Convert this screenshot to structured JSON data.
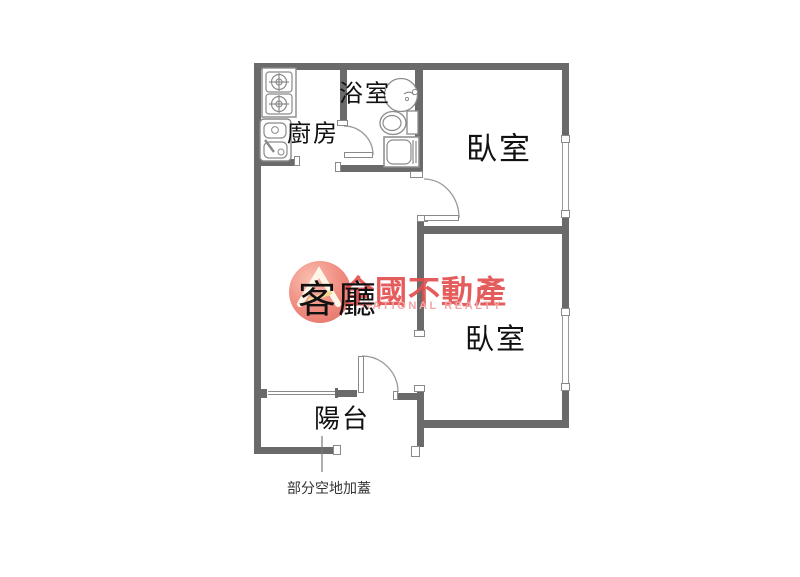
{
  "title": "apartment-floor-plan",
  "rooms": {
    "kitchen": "廚房",
    "bathroom": "浴室",
    "bedroom_top": "臥室",
    "bedroom_bottom": "臥室",
    "living_room": "客廳",
    "balcony": "陽台"
  },
  "annotation": {
    "balcony_note": "部分空地加蓋"
  },
  "watermark": {
    "brand": "全國不動產",
    "subtitle": "NATIONAL REALTY"
  },
  "colors": {
    "background": "#ffffff",
    "wall": "#6a6a6a",
    "line": "#999999",
    "text": "#111111",
    "brand_red": "#e34f4f",
    "brand_pink": "#f2a5a5",
    "logo_salmon": "#ee8276"
  }
}
